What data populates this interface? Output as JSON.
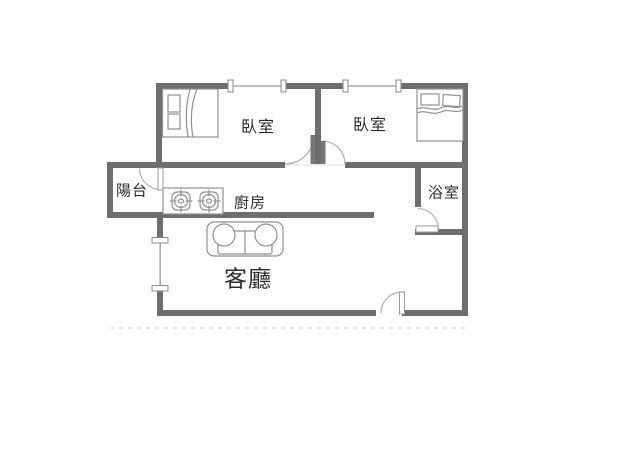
{
  "figure": {
    "kind": "apartment-floor-plan",
    "background": "#ffffff"
  },
  "colors": {
    "wall": "#6e6e6e",
    "furniture_outline": "#909090",
    "door_arc": "#b4b4b4",
    "door_leaf_dark": "#777777",
    "window_line": "#ababab",
    "text": "#2b2b2b"
  },
  "rooms": {
    "bedroom_1": {
      "label": "臥室"
    },
    "bedroom_2": {
      "label": "臥室"
    },
    "balcony": {
      "label": "陽台"
    },
    "kitchen": {
      "label": "廚房"
    },
    "bathroom": {
      "label": "浴室"
    },
    "living_room": {
      "label": "客廳"
    }
  },
  "furniture": {
    "bed_1": "double-bed-vertical",
    "bed_2": "double-bed-horizontal",
    "stove": "two-burner-gas-stove",
    "sofa": "loveseat-sofa"
  },
  "fixtures": {
    "window_count": 3,
    "door_count": 5
  }
}
